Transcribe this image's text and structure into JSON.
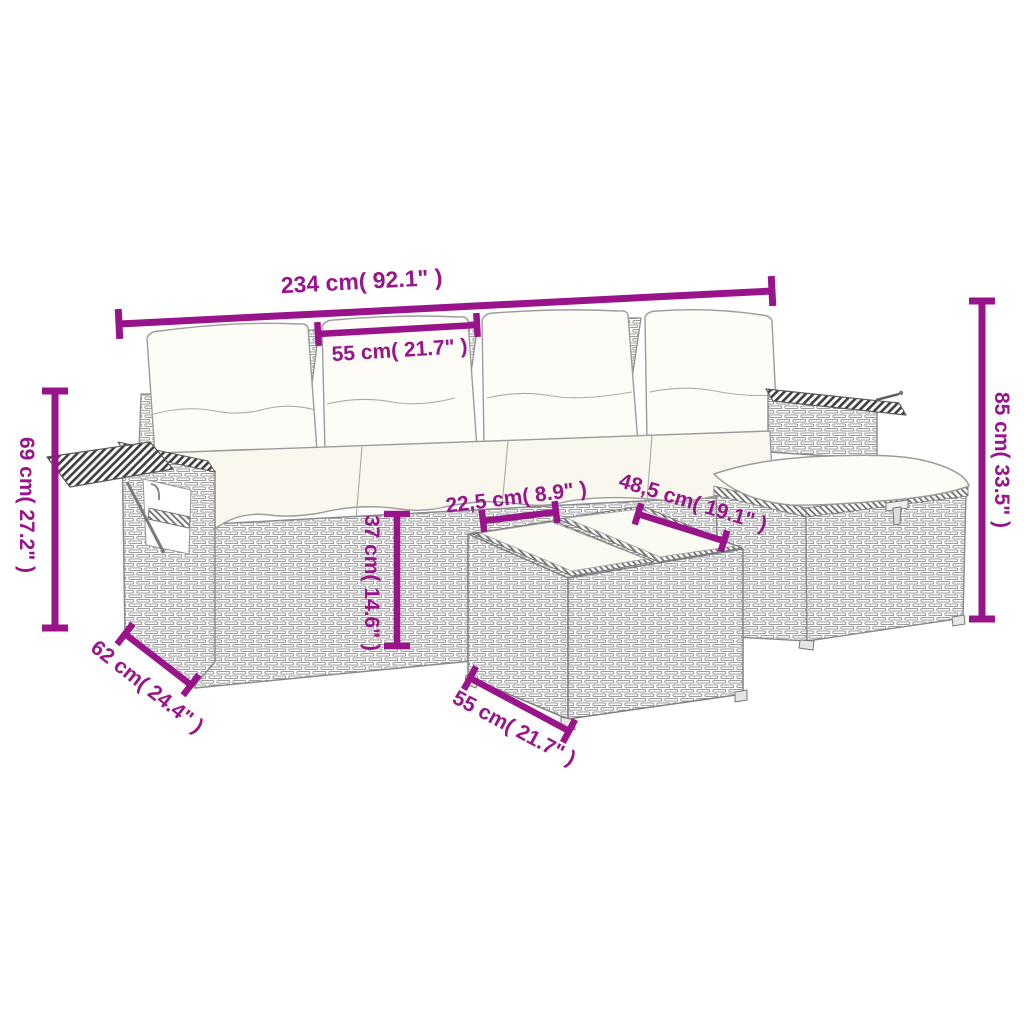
{
  "figure": {
    "description": "Line-drawing dimension diagram of a poly rattan garden lounge set: sofa with four back cushions, folding side tables on both armrests, a cushioned storage ottoman and a two-tray table ottoman",
    "units": "centimetres with inches in parentheses"
  },
  "colors": {
    "dimension": "#99138a",
    "outline": "#8a8a8a",
    "weave_stroke": "#8f8f8f",
    "hatch": "#3f3f3f",
    "cushion": "#fdfcf6",
    "seat_cushion": "#faf8ee",
    "background": "#ffffff"
  },
  "dimensions": [
    {
      "id": "overall-width",
      "label": "234 cm( 92.1\" )",
      "cm": "234 cm",
      "inches": "92.1\"",
      "line": {
        "x1": 119,
        "y1": 324,
        "x2": 772,
        "y2": 291
      },
      "tick": 30,
      "stroke": 7,
      "text": {
        "x": 362,
        "y": 289,
        "angle": -3,
        "size": 23
      }
    },
    {
      "id": "seat-width",
      "label": "55 cm( 21.7\" )",
      "cm": "55 cm",
      "inches": "21.7\"",
      "line": {
        "x1": 318,
        "y1": 334,
        "x2": 477,
        "y2": 325
      },
      "tick": 24,
      "stroke": 6.5,
      "text": {
        "x": 400,
        "y": 357,
        "angle": -3.5,
        "size": 21
      }
    },
    {
      "id": "left-table-height",
      "label": "69 cm( 27.2\" )",
      "cm": "69 cm",
      "inches": "27.2\"",
      "line": {
        "x1": 55,
        "y1": 391,
        "x2": 55,
        "y2": 628
      },
      "tick": 26,
      "stroke": 7,
      "text": {
        "x": 20,
        "y": 505,
        "angle": 90,
        "size": 21
      }
    },
    {
      "id": "back-height",
      "label": "85 cm( 33.5\" )",
      "cm": "85 cm",
      "inches": "33.5\"",
      "line": {
        "x1": 982,
        "y1": 301,
        "x2": 982,
        "y2": 619
      },
      "tick": 26,
      "stroke": 7,
      "text": {
        "x": 995,
        "y": 460,
        "angle": 90,
        "size": 21
      }
    },
    {
      "id": "seat-height",
      "label": "37 cm( 14.6\" )",
      "cm": "37 cm",
      "inches": "14.6\"",
      "line": {
        "x1": 397,
        "y1": 514,
        "x2": 397,
        "y2": 646
      },
      "tick": 26,
      "stroke": 6.5,
      "text": {
        "x": 365,
        "y": 583,
        "angle": 90,
        "size": 21
      }
    },
    {
      "id": "tray-width",
      "label": "22,5 cm( 8.9\" )",
      "cm": "22,5 cm",
      "inches": "8.9\"",
      "line": {
        "x1": 483,
        "y1": 521,
        "x2": 556,
        "y2": 512
      },
      "tick": 22,
      "stroke": 6.5,
      "text": {
        "x": 517,
        "y": 504,
        "angle": -7,
        "size": 21
      }
    },
    {
      "id": "tray-depth",
      "label": "48,5 cm( 19.1\" )",
      "cm": "48,5 cm",
      "inches": "19.1\"",
      "line": {
        "x1": 638,
        "y1": 514,
        "x2": 724,
        "y2": 541
      },
      "tick": 22,
      "stroke": 6.5,
      "text": {
        "x": 691,
        "y": 509,
        "angle": 17,
        "size": 21
      }
    },
    {
      "id": "sofa-depth",
      "label": "62 cm( 24.4\" )",
      "cm": "62 cm",
      "inches": "24.4\"",
      "line": {
        "x1": 125,
        "y1": 634,
        "x2": 191,
        "y2": 685
      },
      "tick": 26,
      "stroke": 6.5,
      "text": {
        "x": 143,
        "y": 692,
        "angle": 38,
        "size": 21
      }
    },
    {
      "id": "ottoman-width",
      "label": "55 cm( 21.7\" )",
      "cm": "55 cm",
      "inches": "21.7\"",
      "line": {
        "x1": 470,
        "y1": 678,
        "x2": 569,
        "y2": 731
      },
      "tick": 26,
      "stroke": 6.5,
      "text": {
        "x": 511,
        "y": 734,
        "angle": 28,
        "size": 21
      }
    }
  ]
}
